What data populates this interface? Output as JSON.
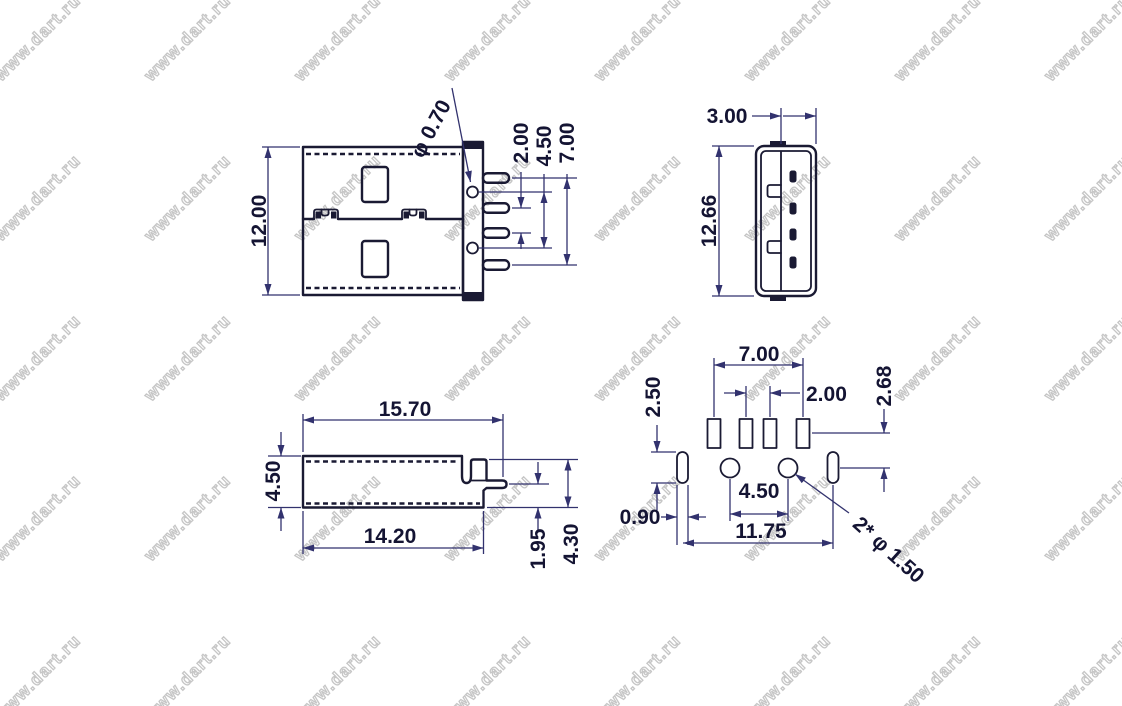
{
  "watermark": {
    "text": "www.dart.ru"
  },
  "colors": {
    "background": "#ffffff",
    "outline": "#1a1a33",
    "dimension_line": "#32326e",
    "label": "#141433",
    "watermark_outline": "#c6c6c6"
  },
  "views": {
    "side": {
      "dims": {
        "body_height": "12.00",
        "hole_diameter": "φ 0.70",
        "middle_pin_pitch": "2.00",
        "hole_spacing": "4.50",
        "pin_span": "7.00"
      }
    },
    "front": {
      "dims": {
        "depth": "3.00",
        "height": "12.66"
      }
    },
    "bottom": {
      "dims": {
        "overall_length": "15.70",
        "body_height": "4.50",
        "body_length": "14.20",
        "pin_offset": "1.95",
        "mount_height": "4.30"
      }
    },
    "footprint": {
      "dims": {
        "pad_span": "7.00",
        "middle_pad_pitch": "2.00",
        "row_offset": "2.68",
        "slot_length": "2.50",
        "hole_spacing": "4.50",
        "slot_width": "0.90",
        "mount_span": "11.75",
        "hole_note": "2* φ 1.50"
      }
    }
  }
}
